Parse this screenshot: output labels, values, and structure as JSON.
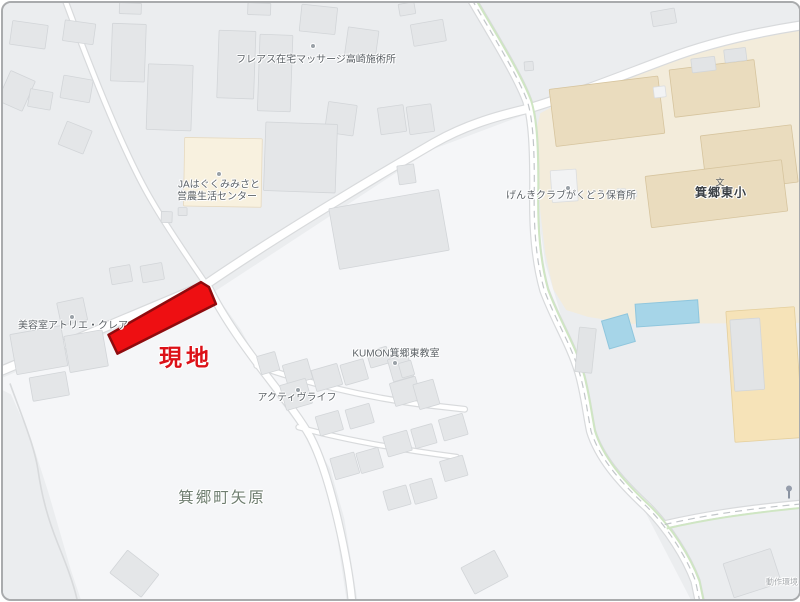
{
  "map": {
    "colors": {
      "bg": "#ebedef",
      "field": "#f5f6f8",
      "casing": "#d8dadc",
      "road": "#ffffff",
      "green": "#cfe6c3",
      "dash": "#c2c6c9",
      "school_area": "#f3ecdb",
      "school_building": "#eadcbe",
      "school_building_border": "#d6c49e",
      "building": "#e4e6e8",
      "building_border": "#d2d5d8",
      "roof": "#e2e4e6",
      "roof_border": "#d3d6d8",
      "white_building": "#f2f3f4",
      "white_building_border": "#dbdddf",
      "ja_building": "#f8f1df",
      "ja_building_border": "#e6d9bf",
      "gym": "#f6e3b8",
      "gym_border": "#e4cf9d",
      "pool": "#a6d5e8",
      "pool_border": "#8fc6dd",
      "site_fill": "#ee0f12",
      "site_border": "#8f0b0e"
    },
    "fields": [
      "0,377 198,293 213,296 248,357 268,387 301,431 320,471 333,519 346,606 80,606 68,570 46,494 28,438 8,394 0,390",
      "212,291 430,148 523,113 531,109 537,160 539,220 545,262 555,295 574,360 589,425 599,455 639,500 694,606 357,606 343,519 329,469 311,439 287,407 263,373 239,329"
    ],
    "school_polygon": "540,111 572,94 640,68 718,43 806,25 806,322 632,323 588,316 566,309 553,288 545,252 540,210 538,158 536,128",
    "thin_path": "M 7 383 C 17 411 31 444 35 469 C 39 497 45 519 55 544 C 63 564 71 584 75 603",
    "roads": [
      {
        "d": "M 62 -4 C 82 50 120 150 150 200 C 165 226 185 255 202 280",
        "w": 4.5
      },
      {
        "d": "M -6 372 L 203 284 C 280 231 390 166 433 141 C 475 117 515 110 529 106 C 575 92 625 72 668 56 C 710 40 760 29 806 22",
        "w": 8
      },
      {
        "d": "M 207 287 C 222 318 246 350 261 370 C 284 400 299 419 309 437 C 321 460 330 493 337 523 C 343 549 349 580 351 606",
        "w": 6.5
      },
      {
        "d": "M 471 -4 C 492 32 518 74 527 99 C 533 118 534 148 534 184 C 533 228 536 260 544 289 C 555 319 571 344 579 371 C 585 391 587 411 591 431 C 599 457 619 481 647 507 C 669 529 687 558 696 582 L 701 606",
        "w": 8
      },
      {
        "d": "M 665 525 C 700 517 740 510 806 504",
        "w": 6.5
      },
      {
        "d": "M 255 365 C 300 381 360 396 420 404 L 464 409",
        "w": 4.5
      },
      {
        "d": "M 297 427 C 340 439 395 449 456 457",
        "w": 4
      }
    ],
    "green_routes": [
      "M 475 -4 C 496 32 522 74 531 99 C 537 118 538 148 538 184 C 537 228 540 260 548 289 C 559 319 575 344 583 371 C 589 391 591 411 595 431 C 603 457 623 481 651 507 C 673 529 691 558 700 582 L 705 606",
      "M 667 529 C 702 521 742 514 806 508"
    ],
    "dash_lines": [
      "M 471 -4 C 492 32 518 74 527 99 C 533 118 534 148 534 184 C 533 228 536 260 544 289 C 555 319 571 344 579 371 C 585 391 587 411 591 431 C 599 457 619 481 647 507 C 669 529 687 558 696 582 L 701 606",
      "M 665 525 C 700 517 740 510 806 504"
    ],
    "pools": [
      {
        "x": 636,
        "y": 301,
        "w": 63,
        "h": 23,
        "r": -4
      },
      {
        "x": 605,
        "y": 316,
        "w": 27,
        "h": 29,
        "r": -16
      }
    ],
    "buildings": [
      {
        "x": 8,
        "y": 20,
        "w": 36,
        "h": 24,
        "r": 8,
        "t": "g"
      },
      {
        "x": 61,
        "y": 19,
        "w": 31,
        "h": 21,
        "r": 8,
        "t": "g"
      },
      {
        "x": 0,
        "y": 72,
        "w": 27,
        "h": 33,
        "r": 24,
        "t": "g"
      },
      {
        "x": 59,
        "y": 75,
        "w": 30,
        "h": 23,
        "r": 10,
        "t": "g"
      },
      {
        "x": 26,
        "y": 88,
        "w": 23,
        "h": 18,
        "r": 10,
        "t": "g"
      },
      {
        "x": 59,
        "y": 123,
        "w": 27,
        "h": 25,
        "r": 22,
        "t": "g"
      },
      {
        "x": 109,
        "y": 21,
        "w": 34,
        "h": 58,
        "r": 2,
        "t": "g"
      },
      {
        "x": 145,
        "y": 62,
        "w": 45,
        "h": 66,
        "r": 2,
        "t": "g"
      },
      {
        "x": 117,
        "y": 0,
        "w": 22,
        "h": 11,
        "r": 2,
        "t": "g"
      },
      {
        "x": 216,
        "y": 28,
        "w": 37,
        "h": 68,
        "r": 2,
        "t": "g"
      },
      {
        "x": 257,
        "y": 32,
        "w": 33,
        "h": 77,
        "r": 2,
        "t": "g"
      },
      {
        "x": 246,
        "y": 0,
        "w": 23,
        "h": 12,
        "r": 2,
        "t": "g"
      },
      {
        "x": 299,
        "y": 3,
        "w": 36,
        "h": 27,
        "r": 6,
        "t": "g"
      },
      {
        "x": 345,
        "y": 26,
        "w": 31,
        "h": 29,
        "r": 8,
        "t": "g"
      },
      {
        "x": 325,
        "y": 101,
        "w": 29,
        "h": 31,
        "r": 8,
        "t": "g"
      },
      {
        "x": 182,
        "y": 136,
        "w": 78,
        "h": 69,
        "r": 1,
        "t": "ja"
      },
      {
        "x": 176,
        "y": 206,
        "w": 9,
        "h": 8,
        "r": 0,
        "t": "g"
      },
      {
        "x": 159,
        "y": 210,
        "w": 11,
        "h": 11,
        "r": 2,
        "t": "g"
      },
      {
        "x": 263,
        "y": 121,
        "w": 72,
        "h": 69,
        "r": 2,
        "t": "g"
      },
      {
        "x": 332,
        "y": 197,
        "w": 112,
        "h": 62,
        "r": -10,
        "t": "g"
      },
      {
        "x": 108,
        "y": 265,
        "w": 21,
        "h": 17,
        "r": -10,
        "t": "g"
      },
      {
        "x": 139,
        "y": 263,
        "w": 22,
        "h": 17,
        "r": -10,
        "t": "g"
      },
      {
        "x": 411,
        "y": 19,
        "w": 33,
        "h": 22,
        "r": -10,
        "t": "g"
      },
      {
        "x": 398,
        "y": 0,
        "w": 16,
        "h": 12,
        "r": -10,
        "t": "g"
      },
      {
        "x": 524,
        "y": 59,
        "w": 9,
        "h": 9,
        "r": -5,
        "t": "g"
      },
      {
        "x": 652,
        "y": 7,
        "w": 24,
        "h": 15,
        "r": -10,
        "t": "g"
      },
      {
        "x": 378,
        "y": 104,
        "w": 26,
        "h": 27,
        "r": -8,
        "t": "g"
      },
      {
        "x": 407,
        "y": 103,
        "w": 25,
        "h": 28,
        "r": -8,
        "t": "g"
      },
      {
        "x": 397,
        "y": 163,
        "w": 17,
        "h": 19,
        "r": -8,
        "t": "g"
      },
      {
        "x": 56,
        "y": 299,
        "w": 27,
        "h": 23,
        "r": -12,
        "t": "g"
      },
      {
        "x": 10,
        "y": 329,
        "w": 52,
        "h": 41,
        "r": -10,
        "t": "g"
      },
      {
        "x": 64,
        "y": 332,
        "w": 39,
        "h": 37,
        "r": -10,
        "t": "g"
      },
      {
        "x": 28,
        "y": 374,
        "w": 37,
        "h": 24,
        "r": -10,
        "t": "g"
      },
      {
        "x": 112,
        "y": 560,
        "w": 40,
        "h": 29,
        "r": 38,
        "t": "g"
      },
      {
        "x": 257,
        "y": 353,
        "w": 19,
        "h": 19,
        "r": -16,
        "t": "g"
      },
      {
        "x": 283,
        "y": 361,
        "w": 26,
        "h": 21,
        "r": -16,
        "t": "g"
      },
      {
        "x": 312,
        "y": 366,
        "w": 27,
        "h": 22,
        "r": -16,
        "t": "g"
      },
      {
        "x": 341,
        "y": 361,
        "w": 24,
        "h": 21,
        "r": -16,
        "t": "g"
      },
      {
        "x": 367,
        "y": 348,
        "w": 21,
        "h": 17,
        "r": -16,
        "t": "g"
      },
      {
        "x": 389,
        "y": 356,
        "w": 21,
        "h": 23,
        "r": -16,
        "t": "g"
      },
      {
        "x": 281,
        "y": 381,
        "w": 27,
        "h": 26,
        "r": -16,
        "t": "g"
      },
      {
        "x": 391,
        "y": 379,
        "w": 27,
        "h": 24,
        "r": -16,
        "t": "g"
      },
      {
        "x": 415,
        "y": 381,
        "w": 21,
        "h": 26,
        "r": -16,
        "t": "g"
      },
      {
        "x": 316,
        "y": 413,
        "w": 24,
        "h": 20,
        "r": -16,
        "t": "g"
      },
      {
        "x": 346,
        "y": 406,
        "w": 25,
        "h": 20,
        "r": -16,
        "t": "g"
      },
      {
        "x": 384,
        "y": 433,
        "w": 25,
        "h": 21,
        "r": -16,
        "t": "g"
      },
      {
        "x": 412,
        "y": 426,
        "w": 22,
        "h": 20,
        "r": -16,
        "t": "g"
      },
      {
        "x": 440,
        "y": 416,
        "w": 25,
        "h": 22,
        "r": -16,
        "t": "g"
      },
      {
        "x": 331,
        "y": 455,
        "w": 25,
        "h": 22,
        "r": -16,
        "t": "g"
      },
      {
        "x": 357,
        "y": 450,
        "w": 23,
        "h": 21,
        "r": -16,
        "t": "g"
      },
      {
        "x": 384,
        "y": 488,
        "w": 24,
        "h": 20,
        "r": -16,
        "t": "g"
      },
      {
        "x": 411,
        "y": 481,
        "w": 23,
        "h": 21,
        "r": -16,
        "t": "g"
      },
      {
        "x": 441,
        "y": 458,
        "w": 24,
        "h": 21,
        "r": -16,
        "t": "g"
      },
      {
        "x": 399,
        "y": 361,
        "w": 13,
        "h": 15,
        "r": -16,
        "t": "g"
      },
      {
        "x": 465,
        "y": 558,
        "w": 38,
        "h": 30,
        "r": -28,
        "t": "g"
      },
      {
        "x": 728,
        "y": 556,
        "w": 50,
        "h": 36,
        "r": -18,
        "t": "g"
      },
      {
        "x": 552,
        "y": 80,
        "w": 110,
        "h": 58,
        "r": -7,
        "t": "s"
      },
      {
        "x": 672,
        "y": 62,
        "w": 86,
        "h": 48,
        "r": -7,
        "t": "s"
      },
      {
        "x": 704,
        "y": 128,
        "w": 92,
        "h": 58,
        "r": -7,
        "t": "s"
      },
      {
        "x": 648,
        "y": 166,
        "w": 138,
        "h": 52,
        "r": -7,
        "t": "s"
      },
      {
        "x": 692,
        "y": 55,
        "w": 24,
        "h": 14,
        "r": -7,
        "t": "l"
      },
      {
        "x": 725,
        "y": 46,
        "w": 22,
        "h": 13,
        "r": -7,
        "t": "l"
      },
      {
        "x": 654,
        "y": 84,
        "w": 12,
        "h": 11,
        "r": -7,
        "t": "w"
      },
      {
        "x": 551,
        "y": 168,
        "w": 26,
        "h": 32,
        "r": -4,
        "t": "w"
      },
      {
        "x": 617,
        "y": 187,
        "w": 9,
        "h": 7,
        "r": 0,
        "t": "w"
      },
      {
        "x": 629,
        "y": 189,
        "w": 8,
        "h": 6,
        "r": 0,
        "t": "w"
      },
      {
        "x": 577,
        "y": 327,
        "w": 17,
        "h": 45,
        "r": 6,
        "t": "l"
      },
      {
        "x": 731,
        "y": 308,
        "w": 69,
        "h": 132,
        "r": -4,
        "t": "gym"
      },
      {
        "x": 733,
        "y": 318,
        "w": 30,
        "h": 72,
        "r": -4,
        "t": "l"
      }
    ],
    "site": {
      "points": "106,334 199,281 207,286 214,303 115,353",
      "label": "現地"
    },
    "labels": [
      {
        "text": "フレアス在宅マッサージ高崎施術所",
        "x": 313,
        "y": 57,
        "size": 10,
        "color": "#5c6267",
        "weight": "normal",
        "spacing": 0
      },
      {
        "text": "JAはぐくみみさと",
        "x": 216,
        "y": 182,
        "size": 10,
        "color": "#5c6267",
        "weight": "normal",
        "spacing": 0
      },
      {
        "text": "営農生活センター",
        "x": 214,
        "y": 194,
        "size": 10,
        "color": "#5c6267",
        "weight": "normal",
        "spacing": 0
      },
      {
        "text": "げんきクラブがくどう保育所",
        "x": 568,
        "y": 193,
        "size": 10,
        "color": "#5c6267",
        "weight": "normal",
        "spacing": 0
      },
      {
        "text": "箕郷東小",
        "x": 718,
        "y": 190,
        "size": 12,
        "color": "#3b4045",
        "weight": "bold",
        "spacing": 1
      },
      {
        "text": "美容室アトリエ・クレア",
        "x": 70,
        "y": 323,
        "size": 10,
        "color": "#5c6267",
        "weight": "normal",
        "spacing": 0
      },
      {
        "text": "KUMON箕郷東教室",
        "x": 393,
        "y": 351,
        "size": 10,
        "color": "#5c6267",
        "weight": "normal",
        "spacing": 0
      },
      {
        "text": "アクティヴライフ",
        "x": 294,
        "y": 395,
        "size": 10,
        "color": "#5c6267",
        "weight": "normal",
        "spacing": 0
      },
      {
        "text": "箕郷町矢原",
        "x": 219,
        "y": 495,
        "size": 15.5,
        "color": "#6f7e70",
        "weight": "normal",
        "spacing": 2
      },
      {
        "text": "現地",
        "x": 183,
        "y": 355,
        "size": 23,
        "color": "#dc1118",
        "weight": "900",
        "spacing": 4
      },
      {
        "text": "動作環境",
        "x": 779,
        "y": 580,
        "size": 8,
        "color": "#a6aaad",
        "weight": "normal",
        "spacing": 0
      }
    ],
    "dots": [
      {
        "x": 310,
        "y": 43
      },
      {
        "x": 216,
        "y": 171
      },
      {
        "x": 565,
        "y": 185
      },
      {
        "x": 69,
        "y": 314
      },
      {
        "x": 392,
        "y": 360
      },
      {
        "x": 295,
        "y": 387
      }
    ],
    "school_icon": {
      "glyph": "文",
      "x": 717,
      "y": 179,
      "size": 9,
      "color": "#4a5056"
    },
    "lamp_icon": {
      "x": 786,
      "y": 489
    }
  }
}
